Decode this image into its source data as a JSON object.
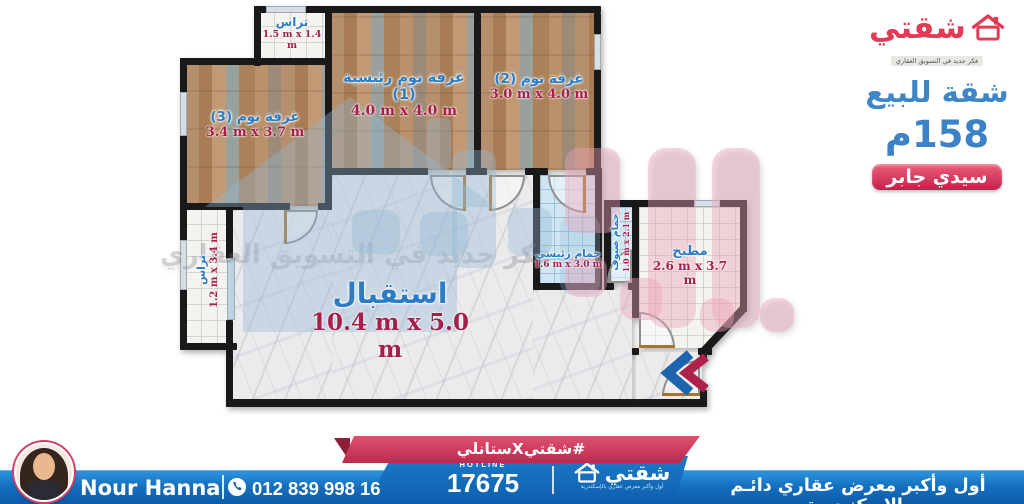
{
  "side_panel": {
    "logo_text": "شقتي",
    "logo_tagline": "فكر جديد في التسويق العقاري",
    "title": "شقة للبيع",
    "area": "158م",
    "location": "سيدي جابر"
  },
  "plan": {
    "watermark_text": "فكر جديد في التسويق العقاري",
    "rooms": [
      {
        "id": "terrace-top",
        "name": "تراس",
        "dims": "1.5 m x 1.4 m"
      },
      {
        "id": "bedroom-1",
        "name": "غرفة نوم رئيسية (1)",
        "dims": "4.0 m x 4.0 m"
      },
      {
        "id": "bedroom-2",
        "name": "غرفة نوم (2)",
        "dims": "3.0 m x 4.0 m"
      },
      {
        "id": "bedroom-3",
        "name": "غرفة نوم (3)",
        "dims": "3.4 m x 3.7 m"
      },
      {
        "id": "terrace-left",
        "name": "تراس",
        "dims": "1.2 m x 3.4 m"
      },
      {
        "id": "reception",
        "name": "استقبال",
        "dims": "10.4 m x 5.0 m"
      },
      {
        "id": "bath-main",
        "name": "حمام رئيسي",
        "dims": "1.6 m x 3.0 m"
      },
      {
        "id": "bath-guest",
        "name": "حمام ضيوف",
        "dims": "1.0 m x 2.1 m"
      },
      {
        "id": "kitchen",
        "name": "مطبخ",
        "dims": "2.6 m x 3.7 m"
      }
    ]
  },
  "footer": {
    "agent_name": "Nour Hanna",
    "phone": "012 839 998 16",
    "hashtag": "#شقتيXستانلي",
    "hotline_label": "HOTLINE",
    "hotline_number": "17675",
    "logo_text": "شقتي",
    "logo_tagline": "أول وأكبر معرض عقاري بالإسكندرية",
    "tagline": "أول وأكبر معرض عقاري دائـم بالإسكنـدرية"
  },
  "colors": {
    "brand_red": "#e23b55",
    "heading_blue": "#3e86c8",
    "bar_blue": "#0d5fae",
    "ribbon_red": "#bc2a4e",
    "dim_red": "#a81e4a",
    "room_label_blue": "#2b7cc4"
  }
}
